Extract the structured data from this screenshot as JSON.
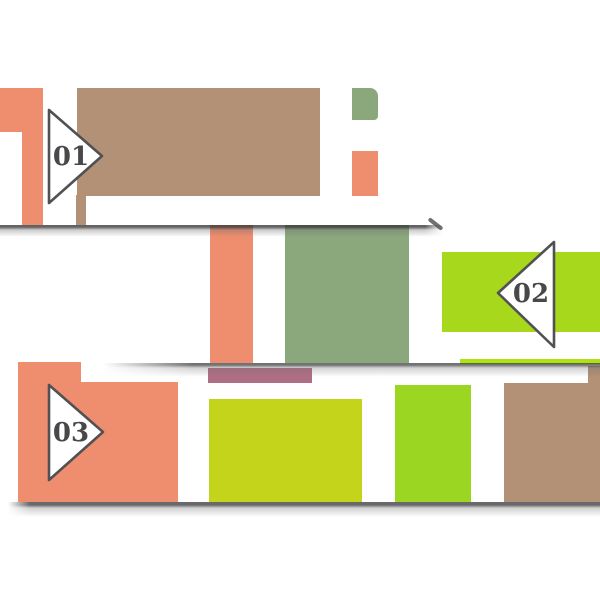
{
  "artboard": {
    "background": "#ffffff",
    "description": "paper banner infographic with three numbered arrow steps"
  },
  "steps": [
    {
      "label": "01",
      "arrow_direction": "right",
      "banner": "top"
    },
    {
      "label": "02",
      "arrow_direction": "left",
      "banner": "middle"
    },
    {
      "label": "03",
      "arrow_direction": "right",
      "banner": "bottom"
    }
  ],
  "palette": {
    "salmon": "#EF8E6F",
    "tan": "#B29176",
    "sage": "#8BA87D",
    "lime": "#A8D81C",
    "lime_strip": "#AEE215",
    "lime_yellow": "#C3D41A",
    "green": "#9BD622",
    "mauve": "#B06E84",
    "outline": "#515154",
    "numeral": "#48484A",
    "shadow": "#3C3C3E"
  }
}
